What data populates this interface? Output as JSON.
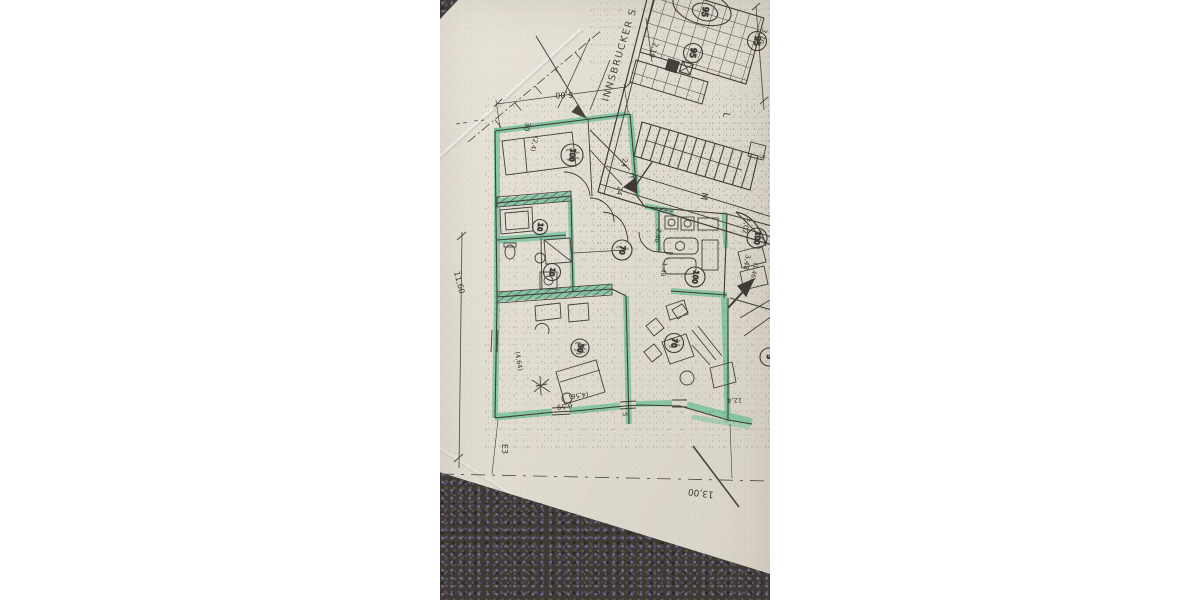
{
  "scene": {
    "description": "Photograph of a photocopied architectural floor plan on paper, one apartment outlined in green highlighter, lying on a dark flecked carpet with white letterbox margins",
    "paper_color": "#e1dcd1",
    "margin_color": "#ffffff",
    "carpet_color": "#3f3a33",
    "carpet_fleck_color": "#6e6a94",
    "highlight_color": "#72c19b",
    "ink_color": "#403c35"
  },
  "plan": {
    "street_label": "INNSBRUCKER S",
    "room_numbers": {
      "c95a": "95",
      "c95b": "95",
      "c95c": "95",
      "c100a": "100",
      "c100b": "100",
      "c100c": "100",
      "c70a": "70",
      "c70b": "70",
      "c30": "30",
      "c10a": "10",
      "c10b": "10",
      "c5": "5"
    },
    "dimensions": {
      "d500": "5,00",
      "d30": "30",
      "d24p": "(2,4)",
      "d1160": "11,60",
      "d1300": "13,00",
      "d210": "2,10",
      "d370": "3,70",
      "d502": "5,02",
      "d348": "3,48",
      "d146": "(1,46)",
      "d24a": "24",
      "d24b": "24",
      "d240": "2,40",
      "d149": "1,49",
      "d464": "(4,64)",
      "d659": "6,59",
      "d456": "(4,56)",
      "d124": "12,4"
    },
    "labels": {
      "m": "M",
      "l": "L",
      "r": "R",
      "e3": "E3",
      "five_box": "5",
      "five_window": "5"
    }
  }
}
